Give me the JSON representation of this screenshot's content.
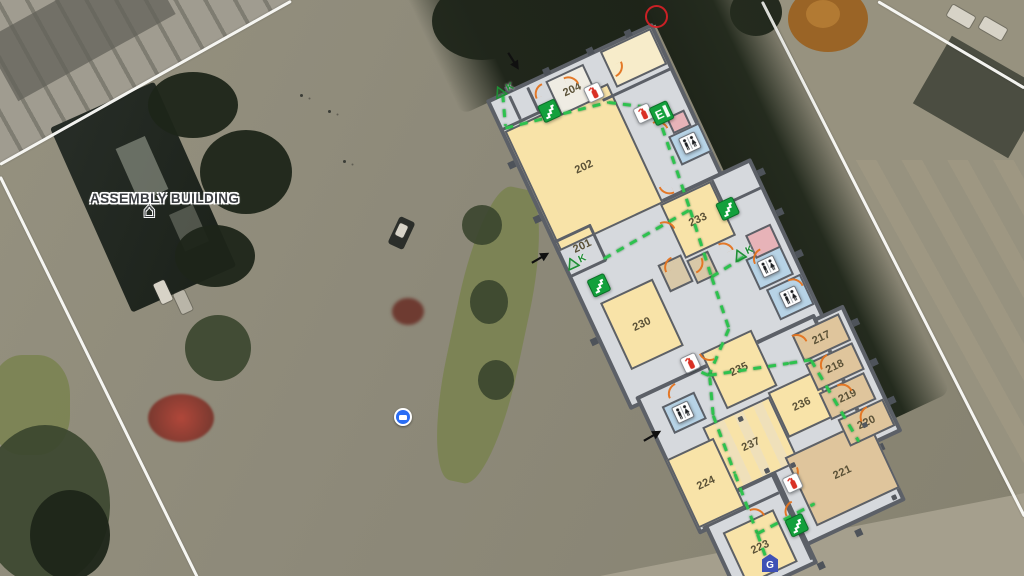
{
  "map": {
    "assembly_label": "ASSEMBLY BUILDING",
    "colors": {
      "wall": "#5c6067",
      "corridor": "#d6d9dd",
      "room_yellow": "#f8e3a8",
      "room_tan": "#dfc59c",
      "room_blue": "#b7d3e6",
      "room_pink": "#e7b3b8",
      "route_green": "#2ec24e",
      "door_orange": "#e4731f",
      "exit_green": "#13a03c",
      "extinguisher_red": "#d93025",
      "boundary_white": "#fcfcf9",
      "badge_blue": "#3f51b5"
    }
  },
  "floorplan": {
    "angle_deg": -25,
    "origin": {
      "x": 490,
      "y": 105
    },
    "blocks": [
      {
        "x": -2,
        "y": -6,
        "w": 184,
        "h": 172
      },
      {
        "x": -2,
        "y": 158,
        "w": 216,
        "h": 178
      },
      {
        "x": 172,
        "y": 330,
        "w": 64,
        "h": 140
      },
      {
        "x": 8,
        "y": 326,
        "w": 198,
        "h": 152
      },
      {
        "x": 98,
        "y": 444,
        "w": 112,
        "h": 90
      },
      {
        "x": 16,
        "y": 452,
        "w": 88,
        "h": 102
      }
    ],
    "rooms": [
      {
        "label": "202",
        "type": "yellow",
        "x": 2,
        "y": 30,
        "w": 114,
        "h": 132
      },
      {
        "label": "204",
        "type": "white",
        "x": 60,
        "y": 2,
        "w": 42,
        "h": 38
      },
      {
        "label": "",
        "type": "cream",
        "x": 122,
        "y": -2,
        "w": 56,
        "h": 40
      },
      {
        "label": "233",
        "type": "yellow",
        "x": 112,
        "y": 162,
        "w": 56,
        "h": 60
      },
      {
        "label": "201",
        "type": "nofill",
        "x": 4,
        "y": 158,
        "w": 40,
        "h": 18
      },
      {
        "label": "230",
        "type": "yellow",
        "x": 16,
        "y": 226,
        "w": 58,
        "h": 74
      },
      {
        "label": "235",
        "type": "yellow",
        "x": 86,
        "y": 314,
        "w": 56,
        "h": 62
      },
      {
        "label": "236",
        "type": "yellow",
        "x": 130,
        "y": 378,
        "w": 52,
        "h": 50
      },
      {
        "label": "237",
        "type": "striped",
        "x": 56,
        "y": 382,
        "w": 74,
        "h": 72
      },
      {
        "label": "224",
        "type": "yellow",
        "x": 10,
        "y": 396,
        "w": 52,
        "h": 76
      },
      {
        "label": "223",
        "type": "yellow",
        "x": 30,
        "y": 486,
        "w": 56,
        "h": 58
      },
      {
        "label": "221",
        "type": "tan",
        "x": 118,
        "y": 444,
        "w": 92,
        "h": 76
      },
      {
        "label": "217",
        "type": "tan",
        "x": 176,
        "y": 336,
        "w": 52,
        "h": 30
      },
      {
        "label": "218",
        "type": "tan",
        "x": 176,
        "y": 368,
        "w": 52,
        "h": 30
      },
      {
        "label": "219",
        "type": "tan",
        "x": 176,
        "y": 400,
        "w": 50,
        "h": 30
      },
      {
        "label": "220",
        "type": "tan",
        "x": 182,
        "y": 432,
        "w": 50,
        "h": 30
      },
      {
        "label": "",
        "type": "blue",
        "x": 148,
        "y": 104,
        "w": 34,
        "h": 32
      },
      {
        "label": "",
        "type": "blue",
        "x": 166,
        "y": 248,
        "w": 38,
        "h": 34
      },
      {
        "label": "",
        "type": "blue",
        "x": 172,
        "y": 284,
        "w": 38,
        "h": 34
      },
      {
        "label": "",
        "type": "blue",
        "x": 28,
        "y": 346,
        "w": 36,
        "h": 30
      },
      {
        "label": "",
        "type": "pink",
        "x": 154,
        "y": 86,
        "w": 20,
        "h": 18
      },
      {
        "label": "",
        "type": "pink",
        "x": 176,
        "y": 226,
        "w": 28,
        "h": 26
      },
      {
        "label": "",
        "type": "beige",
        "x": 84,
        "y": 216,
        "w": 26,
        "h": 30
      },
      {
        "label": "",
        "type": "beige",
        "x": 112,
        "y": 224,
        "w": 24,
        "h": 26
      }
    ],
    "wall_lines": [
      [
        0,
        26,
        60,
        2.5
      ],
      [
        20,
        0,
        2.5,
        26
      ],
      [
        40,
        0,
        2.5,
        26
      ],
      [
        104,
        42,
        76,
        2.5
      ],
      [
        0,
        150,
        40,
        2.5
      ],
      [
        38,
        150,
        2.5,
        40
      ],
      [
        0,
        188,
        40,
        2.5
      ],
      [
        168,
        162,
        2.5,
        28
      ],
      [
        168,
        188,
        44,
        2.5
      ],
      [
        98,
        452,
        2.5,
        96
      ],
      [
        14,
        472,
        84,
        2.5
      ]
    ],
    "ticks": [
      [
        20,
        -10
      ],
      [
        62,
        -10
      ],
      [
        110,
        -10
      ],
      [
        152,
        -10
      ],
      [
        -9,
        60
      ],
      [
        -9,
        120
      ],
      [
        -9,
        255
      ],
      [
        214,
        172
      ],
      [
        214,
        216
      ],
      [
        214,
        262
      ],
      [
        236,
        348
      ],
      [
        236,
        392
      ],
      [
        236,
        434
      ],
      [
        206,
        472
      ],
      [
        150,
        540
      ],
      [
        102,
        554
      ],
      [
        42,
        558
      ]
    ],
    "columns": [
      [
        92,
        388
      ],
      [
        94,
        446
      ],
      [
        120,
        452
      ],
      [
        202,
        446
      ],
      [
        198,
        524
      ]
    ],
    "routes": [
      [
        16,
        -6,
        5,
        24
      ],
      [
        4,
        26,
        108,
        46
      ],
      [
        108,
        46,
        148,
        71
      ],
      [
        148,
        77,
        137,
        178
      ],
      [
        137,
        178,
        128,
        248
      ],
      [
        38,
        186,
        137,
        178
      ],
      [
        128,
        248,
        170,
        243
      ],
      [
        128,
        248,
        122,
        302
      ],
      [
        122,
        302,
        84,
        336
      ],
      [
        84,
        336,
        72,
        322
      ],
      [
        84,
        336,
        162,
        359
      ],
      [
        162,
        359,
        183,
        365
      ],
      [
        183,
        365,
        192,
        460
      ],
      [
        84,
        338,
        71,
        374
      ],
      [
        71,
        374,
        66,
        436
      ],
      [
        66,
        436,
        61,
        500
      ],
      [
        61,
        500,
        126,
        497
      ],
      [
        61,
        500,
        58,
        533
      ]
    ],
    "doors": [
      [
        44,
        2,
        0
      ],
      [
        78,
        6,
        90
      ],
      [
        126,
        16,
        180
      ],
      [
        140,
        84,
        90
      ],
      [
        118,
        146,
        270
      ],
      [
        104,
        178,
        90
      ],
      [
        88,
        214,
        0
      ],
      [
        116,
        228,
        180
      ],
      [
        148,
        222,
        90
      ],
      [
        172,
        244,
        0
      ],
      [
        196,
        284,
        90
      ],
      [
        38,
        330,
        0
      ],
      [
        84,
        314,
        270
      ],
      [
        176,
        336,
        90
      ],
      [
        188,
        368,
        0
      ],
      [
        196,
        400,
        90
      ],
      [
        202,
        432,
        0
      ],
      [
        114,
        458,
        180
      ],
      [
        64,
        476,
        90
      ],
      [
        94,
        486,
        0
      ]
    ],
    "icons": [
      {
        "type": "fire-extinguisher",
        "x": 91,
        "y": 24
      },
      {
        "type": "fire-extinguisher",
        "x": 127,
        "y": 64
      },
      {
        "type": "fire-extinguisher",
        "x": 64,
        "y": 310
      },
      {
        "type": "fire-extinguisher",
        "x": 106,
        "y": 462
      },
      {
        "type": "exit-sign",
        "x": 142,
        "y": 70,
        "label": "E"
      },
      {
        "type": "stairs",
        "x": 42,
        "y": 21
      },
      {
        "type": "stairs",
        "x": 13,
        "y": 200
      },
      {
        "type": "stairs",
        "x": 162,
        "y": 185
      },
      {
        "type": "stairs",
        "x": 91,
        "y": 501
      },
      {
        "type": "restroom",
        "x": 156,
        "y": 110
      },
      {
        "type": "restroom",
        "x": 175,
        "y": 255
      },
      {
        "type": "restroom",
        "x": 182,
        "y": 292
      },
      {
        "type": "restroom",
        "x": 36,
        "y": 351
      },
      {
        "type": "k-marker",
        "x": 8,
        "y": -14,
        "label": "K"
      },
      {
        "type": "k-marker",
        "x": 1,
        "y": 172,
        "label": "K"
      },
      {
        "type": "k-marker",
        "x": 156,
        "y": 235,
        "label": "K"
      }
    ]
  },
  "overlay": {
    "g_badge": {
      "label": "G"
    },
    "arrows": [
      {
        "x": 506,
        "y": 44,
        "rot": 58
      },
      {
        "x": 532,
        "y": 256,
        "rot": -30
      },
      {
        "x": 644,
        "y": 434,
        "rot": -30
      }
    ]
  }
}
